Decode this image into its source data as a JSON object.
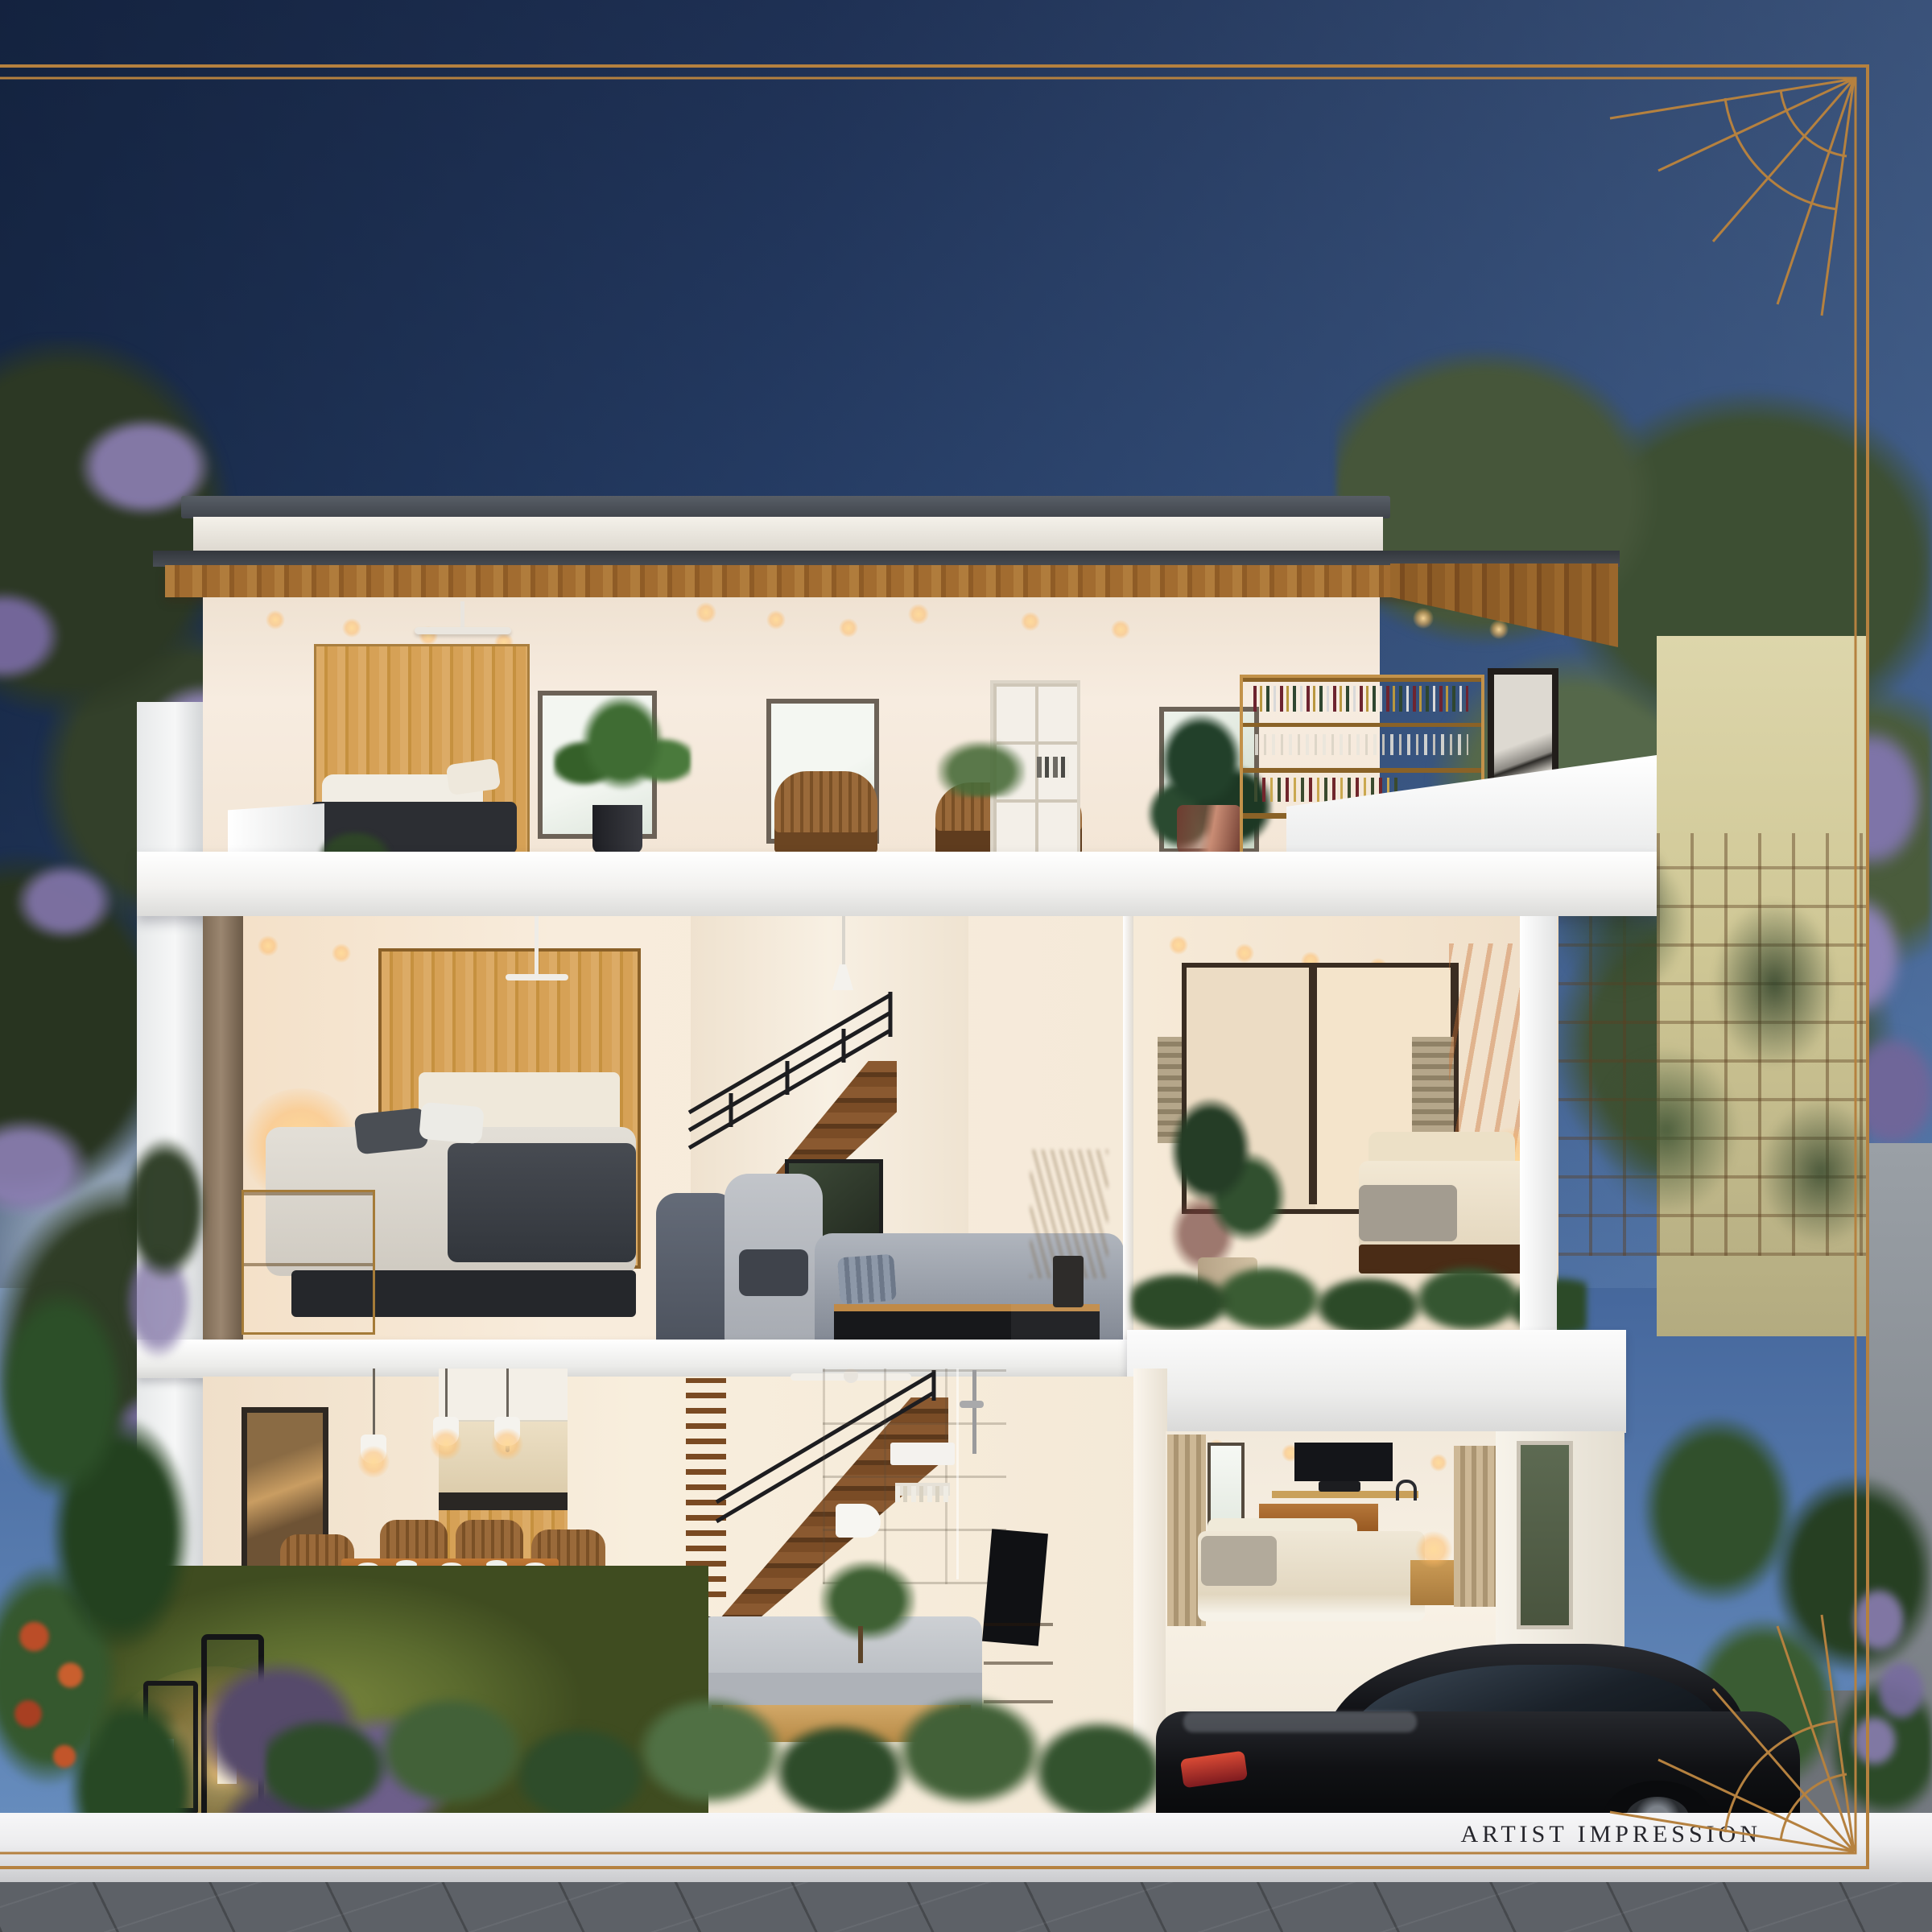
{
  "meta": {
    "type": "architectural-cross-section-render",
    "caption": "ARTIST IMPRESSION"
  },
  "palette": {
    "frame_gold": "#b5813f",
    "caption_ink": "#26262c",
    "sky_top": "#1c2e52",
    "sky_mid": "#33507f",
    "sky_right": "#5d85c2",
    "roof_dark": "#454a52",
    "soffit_wood": "#a5722f",
    "wall_cream": "#f5ebde",
    "slab_white": "#f5f4f2",
    "wood_light": "#d8a75f",
    "wood_dark": "#5c2d13",
    "sofa_gray": "#8b909a",
    "grass_green": "#55652c",
    "foliage_green": "#2d4527",
    "flower_purple": "#8b7ab4",
    "pavement_gray": "#5d6167",
    "accent_wall_tan": "#d5cda0",
    "car_black": "#131417",
    "band_white": "#f2f2f3"
  }
}
